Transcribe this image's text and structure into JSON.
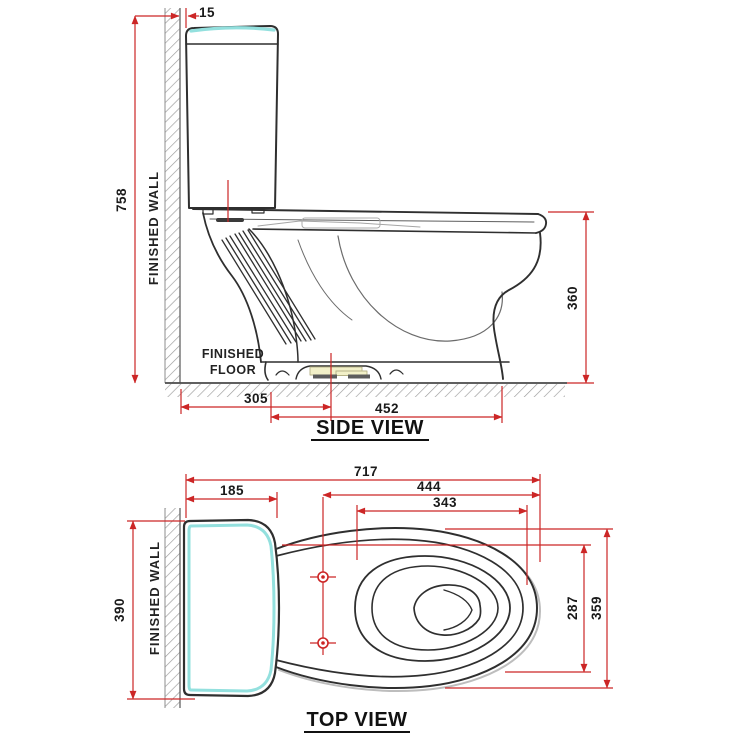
{
  "side_view": {
    "title": "SIDE VIEW",
    "wall_label": "FINISHED WALL",
    "floor_label_line1": "FINISHED",
    "floor_label_line2": "FLOOR",
    "dims": {
      "wall_gap": "15",
      "total_height": "758",
      "rim_height": "360",
      "rough_in": "305",
      "base_depth": "452"
    }
  },
  "top_view": {
    "title": "TOP VIEW",
    "wall_label": "FINISHED WALL",
    "dims": {
      "total_depth": "717",
      "tank_depth": "185",
      "seat_depth": "444",
      "opening_depth": "343",
      "tank_width": "390",
      "opening_width": "287",
      "bowl_width": "359"
    }
  },
  "colors": {
    "dimension_red": "#cc2626",
    "outline_dark": "#2f2f2f",
    "accent_cyan": "#93e0de",
    "hatch_gray": "#9a9a9a",
    "highlight_yellow": "#f2f0c8"
  }
}
